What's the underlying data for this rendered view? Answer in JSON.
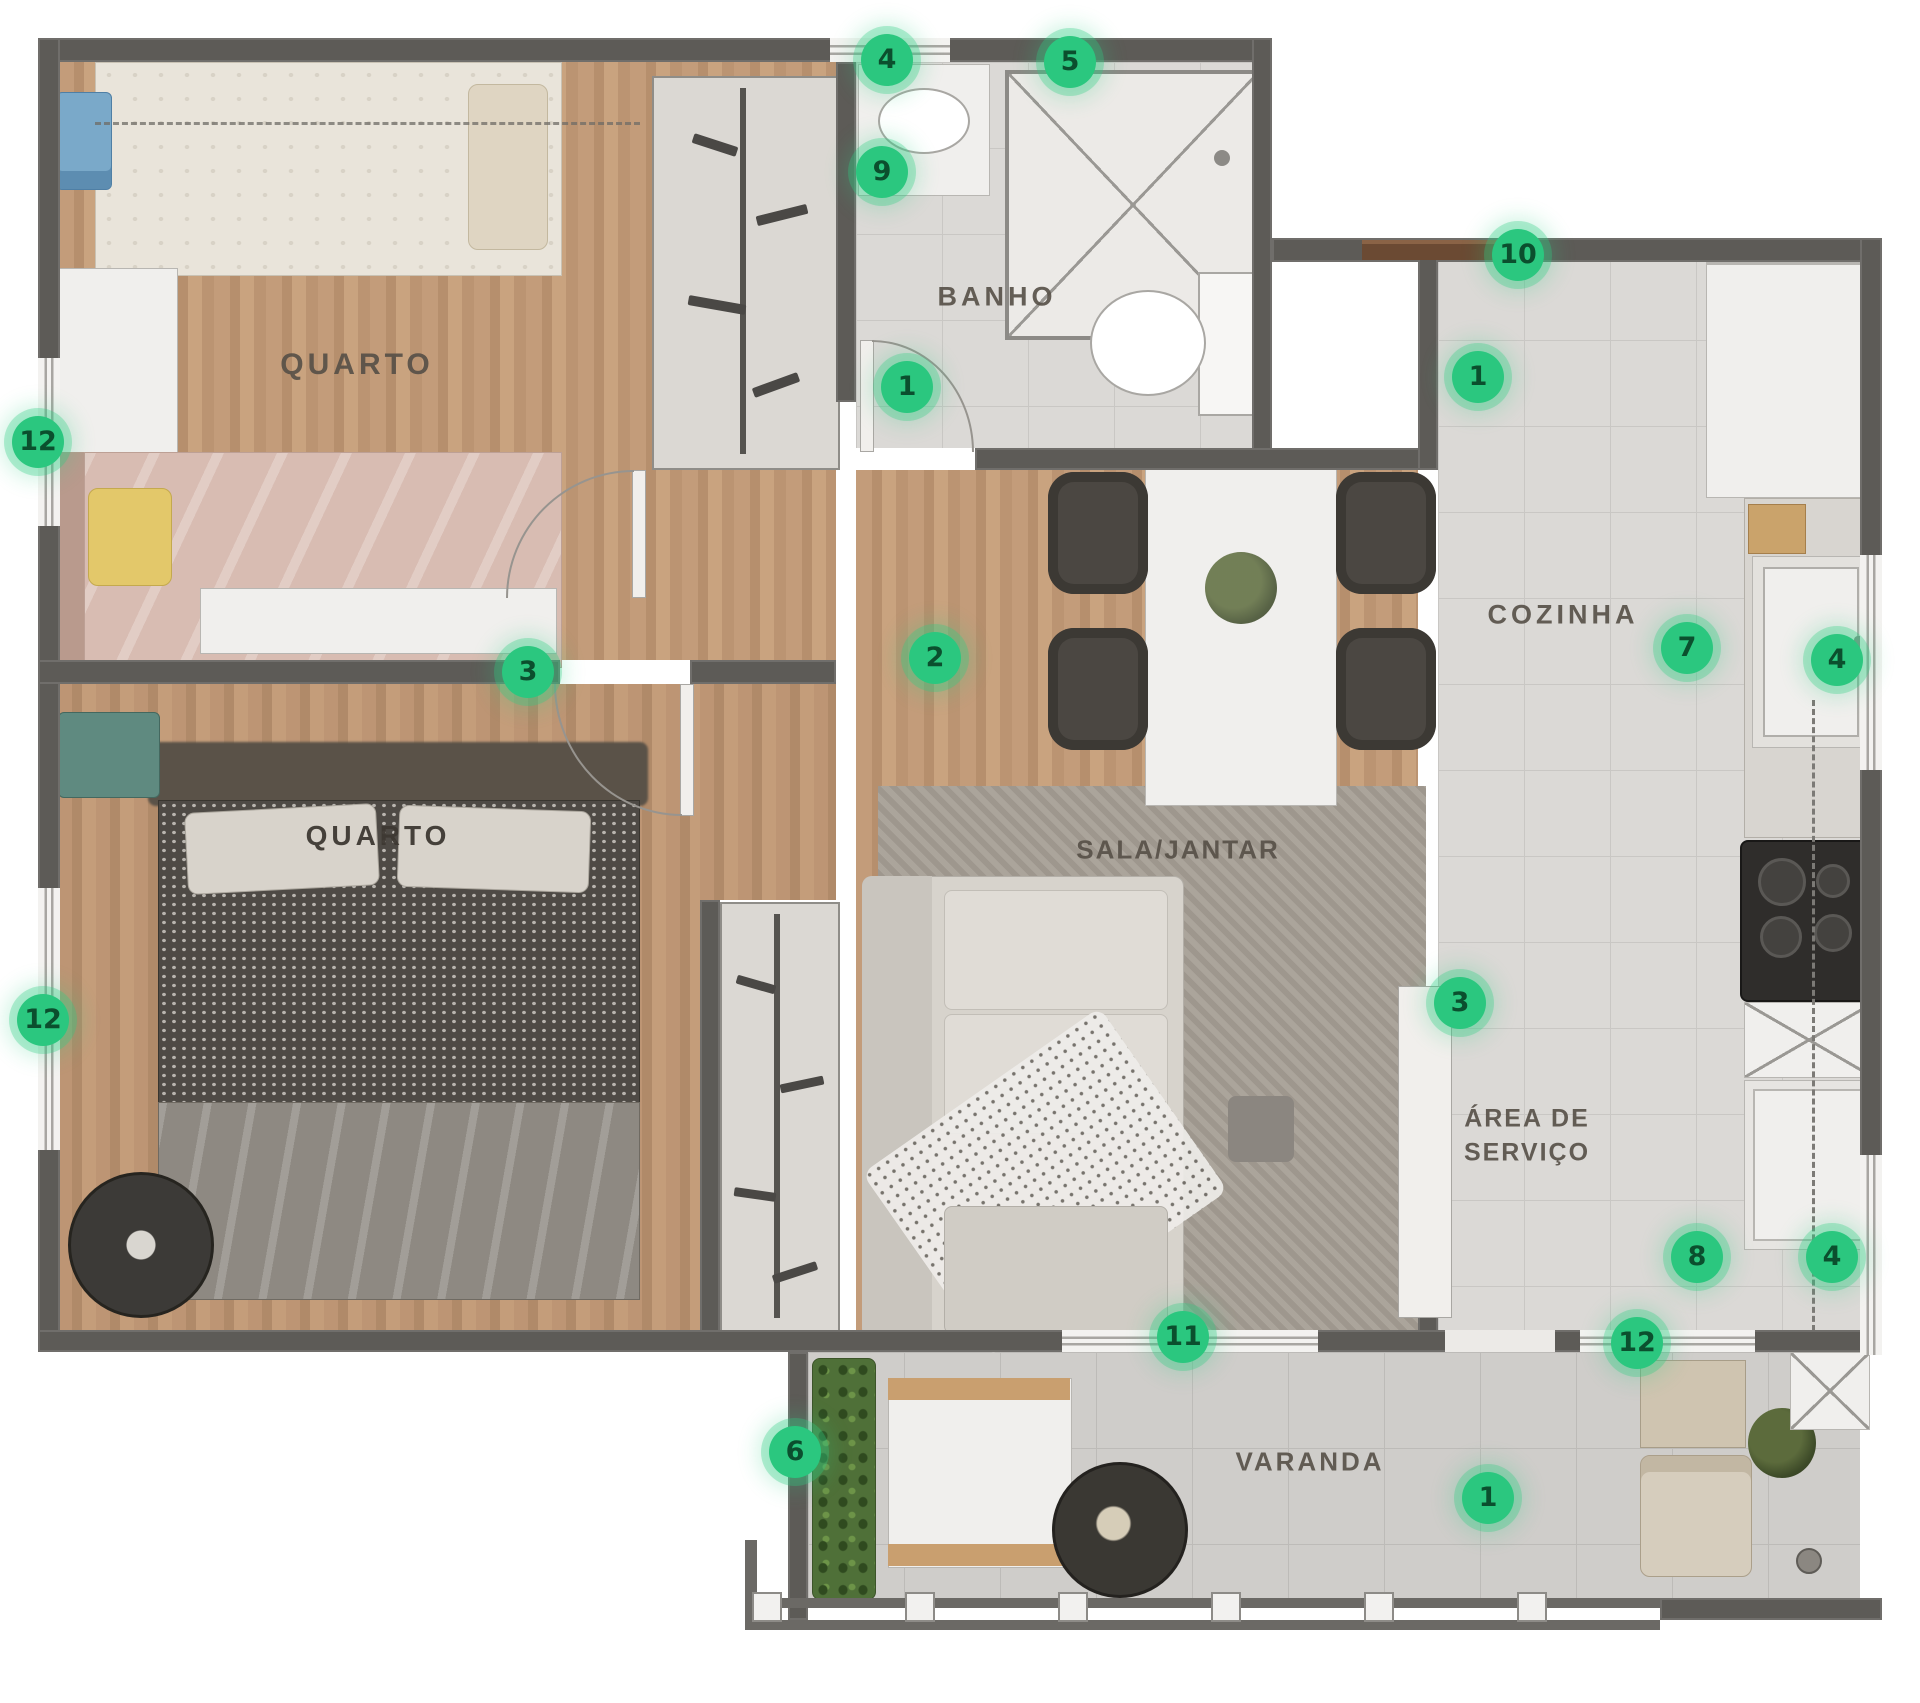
{
  "theme": {
    "accent_color": "#2bc77f",
    "marker_text_color": "#0b4f2e",
    "label_color": "#564f47"
  },
  "plan": {
    "rooms": [
      {
        "id": "quarto1",
        "label": "QUARTO",
        "x": 357,
        "y": 365
      },
      {
        "id": "banho",
        "label": "BANHO",
        "x": 997,
        "y": 297
      },
      {
        "id": "cozinha",
        "label": "COZINHA",
        "x": 1563,
        "y": 615
      },
      {
        "id": "sala",
        "label": "SALA/JANTAR",
        "x": 1178,
        "y": 850
      },
      {
        "id": "quarto2",
        "label": "QUARTO",
        "x": 378,
        "y": 836
      },
      {
        "id": "servico",
        "label": "ÁREA DE\nSERVIÇO",
        "x": 1527,
        "y": 1136
      },
      {
        "id": "varanda",
        "label": "VARANDA",
        "x": 1310,
        "y": 1462
      }
    ],
    "markers": [
      {
        "n": "4",
        "x": 887,
        "y": 60
      },
      {
        "n": "5",
        "x": 1070,
        "y": 62
      },
      {
        "n": "9",
        "x": 882,
        "y": 172
      },
      {
        "n": "1",
        "x": 907,
        "y": 387
      },
      {
        "n": "10",
        "x": 1518,
        "y": 255
      },
      {
        "n": "1",
        "x": 1478,
        "y": 377
      },
      {
        "n": "12",
        "x": 38,
        "y": 442
      },
      {
        "n": "3",
        "x": 528,
        "y": 672
      },
      {
        "n": "2",
        "x": 935,
        "y": 658
      },
      {
        "n": "7",
        "x": 1687,
        "y": 648
      },
      {
        "n": "4",
        "x": 1837,
        "y": 660
      },
      {
        "n": "12",
        "x": 43,
        "y": 1020
      },
      {
        "n": "3",
        "x": 1460,
        "y": 1003
      },
      {
        "n": "8",
        "x": 1697,
        "y": 1257
      },
      {
        "n": "4",
        "x": 1832,
        "y": 1257
      },
      {
        "n": "11",
        "x": 1183,
        "y": 1337
      },
      {
        "n": "12",
        "x": 1637,
        "y": 1343
      },
      {
        "n": "6",
        "x": 795,
        "y": 1452
      },
      {
        "n": "1",
        "x": 1488,
        "y": 1498
      }
    ]
  }
}
